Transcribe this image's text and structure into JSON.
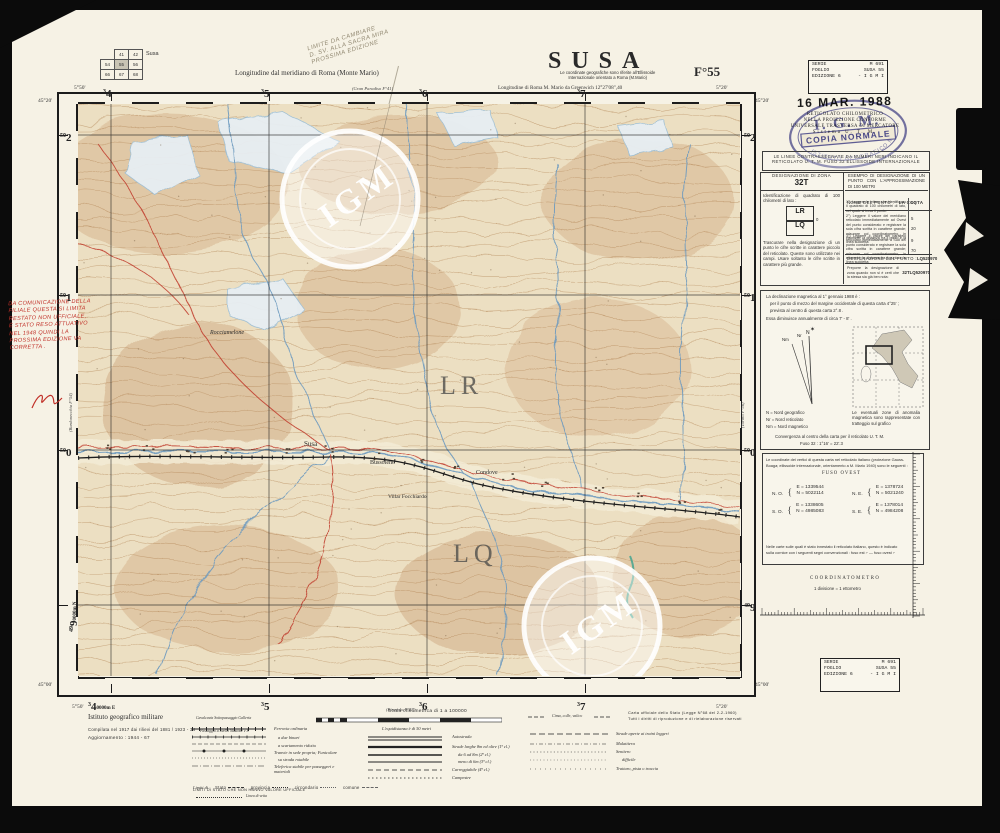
{
  "header": {
    "index_label": "Susa",
    "index_rows": [
      [
        "",
        "41",
        "42"
      ],
      [
        "54",
        "55",
        "56"
      ],
      [
        "66",
        "67",
        "68"
      ]
    ],
    "meridian_note": "Longitudine dal meridiano di Roma  (Monte Mario)",
    "title": "SUSA",
    "sheet": "F°55",
    "coord_note1": "Le coordinate geografiche sono riferite all'Ellissoide",
    "coord_note2": "Internazionale orientato a Roma (M.Mario)",
    "greenwich": "Longitudine di Roma M. Mario da Greenwich 12°27'08\",40",
    "pencil_note": [
      "LIMITE DA CAMBIARE",
      "D. SV. ALLA SACRA MIRA",
      "PROSSIMA EDIZIONE"
    ]
  },
  "stamps": {
    "series_label1": "SERIE",
    "series_value1": "M 691",
    "series_label2": "FOGLIO",
    "series_value2": "SUSA 55",
    "series_label3": "EDIZIONE 6",
    "series_value3": "- I G M I",
    "date": "16 MAR. 1988",
    "utm_lines": [
      "RETICOLATO CHILOMETRICO",
      "NELLA PROIEZIONE CONFORME",
      "UNIVERSALE TRASVERSA DI MERCATORE",
      "Sistema  U. T. M."
    ],
    "oval_igm": "I. G. M.",
    "oval_copy": "COPIA  NORMALE",
    "oval_arc": "ISTITUTO GEOGRAFICO MILITARE",
    "grid_box1": "LE LINEE CONTRASSEGNATE DA NUMERI NERI INDICANO IL",
    "grid_box2": "RETICOLATO U. T. M.  FUSO 32  ELLISSOIDE INTERNAZIONALE"
  },
  "designation": {
    "zone_label": "DESIGNAZIONE DI ZONA",
    "zone_value": "32T",
    "square_note": "Identificazione di quadrato di 100 chilometri di lato :",
    "sq_top": "LR",
    "sq_bottom": "LQ",
    "sq_tick": "0",
    "skip_note": "Trascurare nella designazione di un punto le cifre scritte in carattere piccolo del reticolato. Queste sono utilizzate nei campi. Usare soltanto le cifre scritte in carattere più grande.",
    "example_title": "ESEMPIO DI DESIGNAZIONE DI UN PUNTO CON L'APPROSSIMAZIONE DI 100 METRI",
    "point_label": "NOME DEL PUNTO :",
    "point_value": "LA COSTA",
    "step1": "1°) Leggere le lettere che identificano il quadrato di 100 chilometri di lato, nel quale si trova il punto:",
    "step1_v": "LQ",
    "step2": "2°) Leggere il valore del meridiano reticolato immediatamente ad Ovest del punto considerato e registrare la sola cifra scritta in carattere grande; misurare col coordinatometro, in ettometri, la distanza fra il punto e la linea suddetta:",
    "step2_v1": "5",
    "step2_v2": "20",
    "step3": "3°) Leggere il valore del parallelo reticolato immediatamente a Sud del punto considerato e registrare la sola cifra scritta in carattere grande; misurare col coordinatometro, in ettometri, la distanza fra il punto e la linea suddetta:",
    "step3_v1": "9",
    "step3_v2": "70",
    "desig_label": "DESIGNAZIONE DEL PUNTO :",
    "desig_value": "LQ520970",
    "prefix_note": "Preporre la designazione di zona quando non si è certi che la stessa sia già ben nota:",
    "full_value": "32TLQ520970"
  },
  "declination": {
    "para1": "La declinazione magnetica al 1° gennaio 1988 è :",
    "para2": "per il punto di mezzo del margine occidentale di questa carta 4°25' ;",
    "para3": "prevista al centro di questa carta  2°.8 .",
    "para4": "Essa diminuisce annualmente di circa  7' - 8' .",
    "n_label": "N",
    "nr_label": "Nr",
    "nm_label": "Nm",
    "n_leg": "N   =  Nord geografico",
    "nr_leg": "Nr  =  Nord reticolato",
    "nm_leg": "Nm =  Nord magnetico",
    "anomaly": "Le eventuali zone di anomalia magnetica sono rappresentate con tratteggio sul grafico",
    "conv1": "Convergenza al centro della carta per il reticolato U. T. M.",
    "conv2": "Fuso 32 :  1°16'  =  22'.3"
  },
  "coords": {
    "intro1": "Le coordinate dei vertici di questa carta nel reticolato italiano (proiezione Gauss-",
    "intro2": "Boaga; ellissoide internazionale, orientamento a M. Mario 1940) sono le seguenti :",
    "fuso": "FUSO OVEST",
    "brace": "{",
    "no_label": "N. O.",
    "no_e": "E =  1339544",
    "no_n": "N =  5022114",
    "ne_label": "N. E.",
    "ne_e": "E =  1378724",
    "ne_n": "N =  5021240",
    "so_label": "S. O.",
    "so_e": "E =  1338605",
    "so_n": "N =  4985083",
    "se_label": "S. E.",
    "se_e": "E =  1378014",
    "se_n": "N =  4984208",
    "note1": "Nelle carte sulle quali è stato innestato il reticolato italiano, questo è indicato",
    "note2": "sulla cornice con i seguenti segni convenzionali :  fuso est ⌐   —   fuso ovest ⌐"
  },
  "coordinatometro": {
    "title": "COORDINATOMETRO",
    "sub": "1 divisione  =  1 ettometro"
  },
  "margins": {
    "lon_w": "5°50'",
    "lon_e": "5°20'",
    "lat_n": "45°20'",
    "lat_s": "45°00'",
    "e_small": "3",
    "e_bigs": [
      "4",
      "5",
      "6",
      "7"
    ],
    "e_suffix": "0000m E",
    "n_small": "50",
    "n_bigs": [
      "2",
      "1",
      "0"
    ],
    "n49_small": "49",
    "n49_big": "9",
    "n_suffix": "0000m N",
    "adj_top": "(Gran Paradiso F°41)",
    "adj_bottom": "(Pinerolo F°67)",
    "adj_left": "(Bardonecchia F°54)",
    "adj_right": "(Torino F°56)"
  },
  "map": {
    "sq_lr": "LR",
    "sq_lq": "LQ",
    "watermark": "IGM",
    "towns": [
      "Susa",
      "Bussoleno",
      "Condove",
      "Villar Focchiardo",
      "Rocciamelone"
    ]
  },
  "legend": {
    "institute": "Istituto geografico militare",
    "compiled": "Compilata nel 1917 dai rilievi del 1881 / 1923 - 34",
    "updated": "Aggiornamento :  1944 - 67",
    "scale_title": "Scala chilometrica di 1 a 100000",
    "equidistance": "L'equidistanza è di 50 metri",
    "official1": "Carta ufficiale dello Stato (Legge N°68 del 2-2-1960)",
    "official2": "Tutti i diritti di riproduzione e di rielaborazione riservati",
    "rail_sub1": "Cavalcavia   Sottopassaggio   Galleria",
    "rail_sub2": "Passaggio a livello    Stazione e F.",
    "rail_items": [
      "Ferrovia ordinaria",
      "a due binari",
      "a scartamento ridotto",
      "Tranvie in sede propria; Funicolare",
      "su strada rotabile",
      "Teleferica stabile per passeggeri e materiali"
    ],
    "limits_label": "Limiti di :",
    "limits_items": [
      "Stato",
      "provincia",
      "circondario",
      "comune"
    ],
    "state_note": "LIMITI DI STATO CHE NON HANNO VALORE UFFICIALE",
    "ridge_label": "Linea di vetta",
    "road_items": [
      "Autostrada",
      "Strade larghe 8m ed oltre (1ª cl.)",
      "da 6 ad 8m (2ª cl.)",
      "meno di 6m (3ª cl.)",
      "Carreggiabile (4ª cl.)",
      "Campestre"
    ],
    "pass_label": "Cima, colle, valico",
    "path_items": [
      "Strade aperte ai traini leggeri",
      "Mulattiera",
      "Sentiero",
      "difficile",
      "Tratturo, pista o traccia"
    ]
  },
  "handwriting": {
    "red_lines": [
      "DA COMUNICAZIONE DELLA",
      "FILIALE QUESTA SI LIMITA",
      "RESTATO NON UFFICIALE,",
      "È STATO RESO ATTUATIVO",
      "NEL 1948 QUINDI LA",
      "PROSSIMA EDIZIONE VA",
      "CORRETTA ."
    ]
  },
  "colors": {
    "paper": "#f6f2e5",
    "terrain": "#e9dabb",
    "contour": "#b08050",
    "water": "#6d9abf",
    "road": "#c03a2c",
    "stamp_blue": "#3b3b8f",
    "red_ink": "#c13028"
  }
}
